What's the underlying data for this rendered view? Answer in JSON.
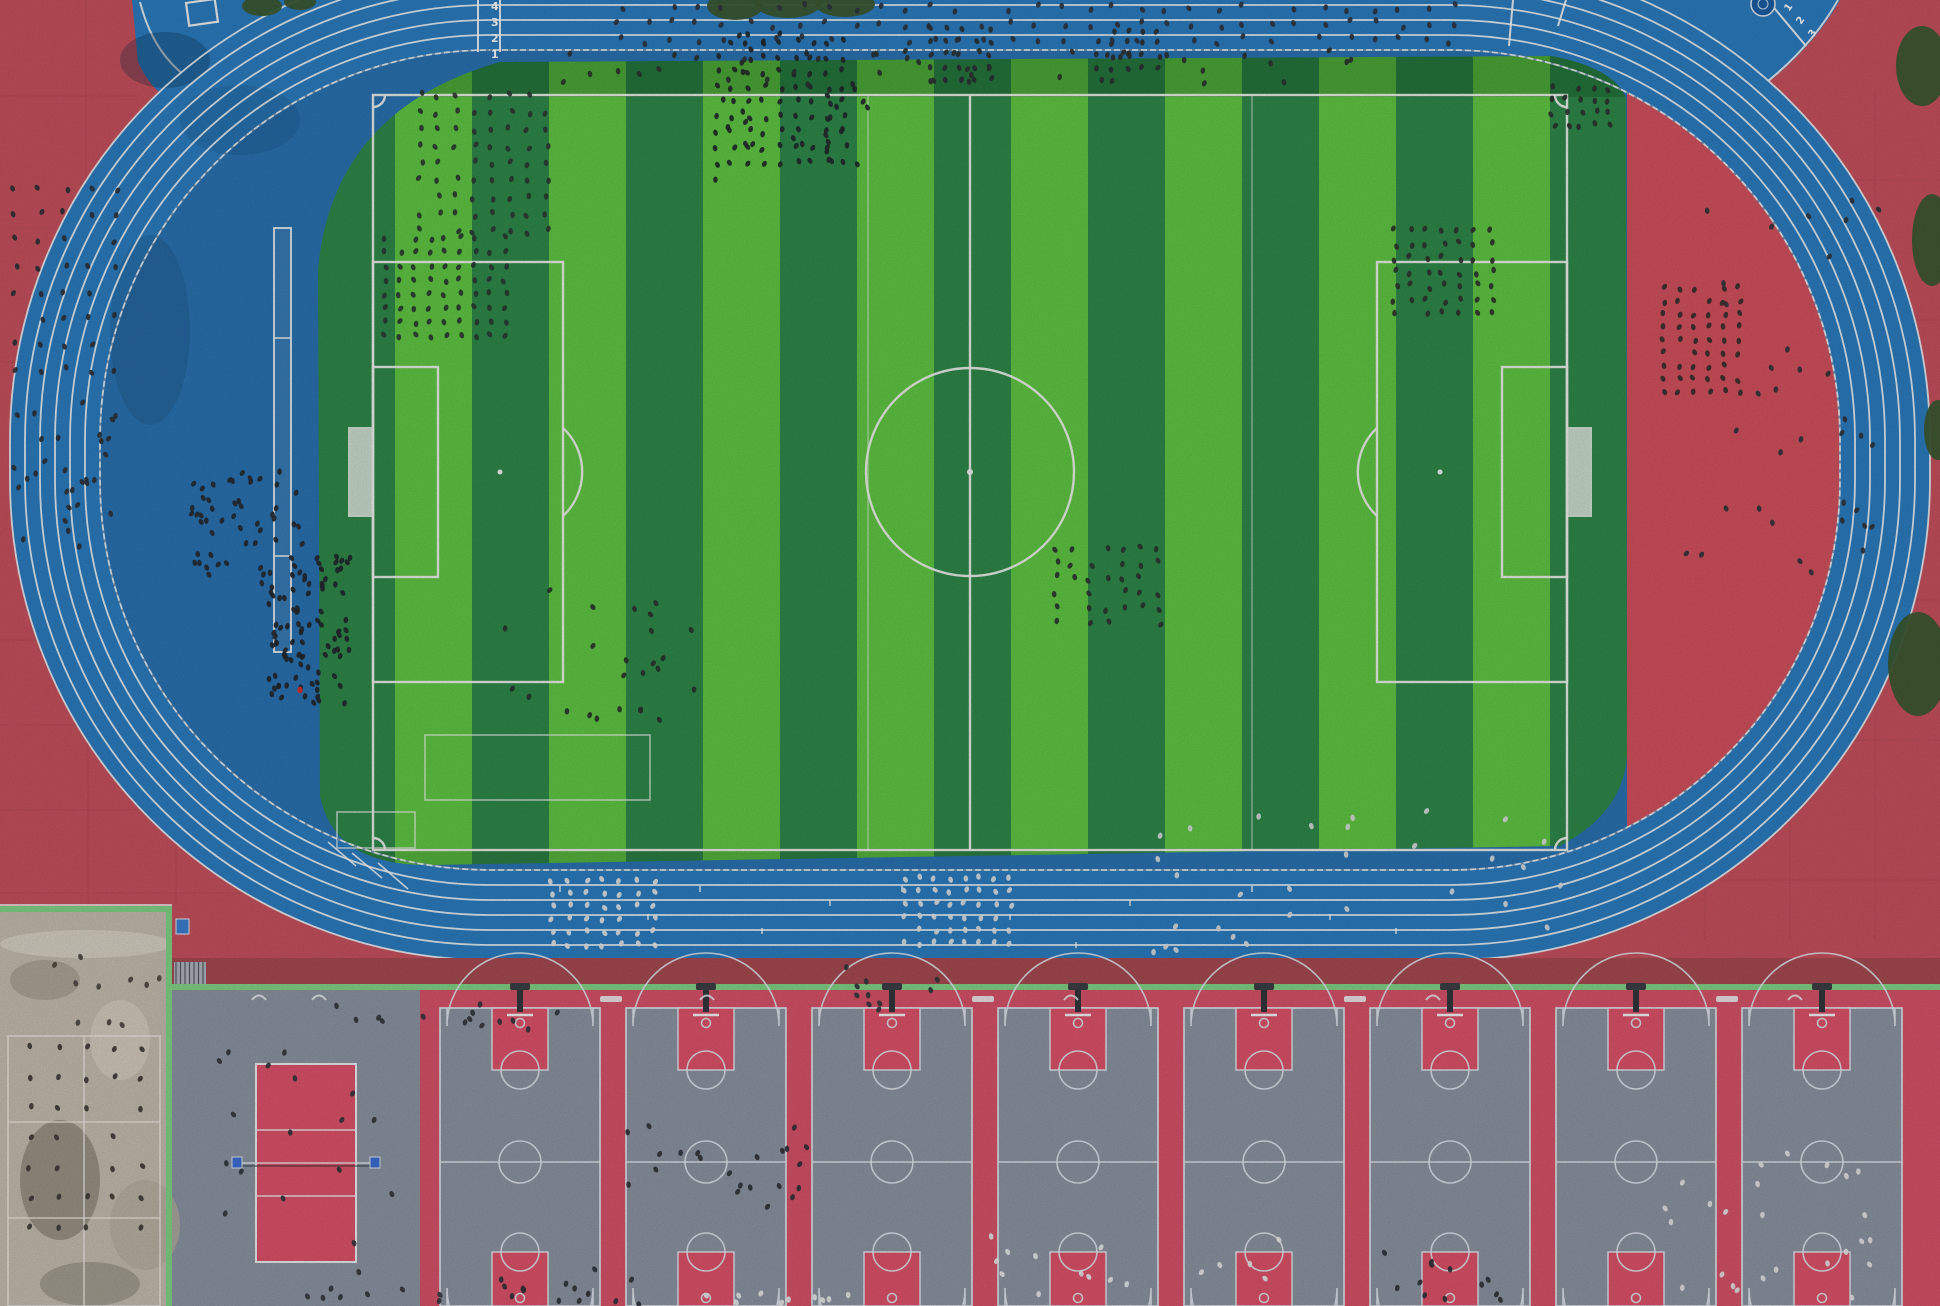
{
  "scene": {
    "title": "Aerial drone view of a school sports complex: blue 6-lane running track around a striped soccer field, red plazas, and a row of basketball courts with a volleyball court below",
    "width": 1940,
    "height": 1306
  },
  "colors": {
    "plaza_red": "#c9525f",
    "infield_red": "#d5525f",
    "strip_red": "#a84b52",
    "track_blue": "#2c7ec2",
    "track_blue_deep": "#2a74b4",
    "lane_line": "#f2f6f8",
    "grass_light": "#61c944",
    "grass_dark": "#2f8a4b",
    "field_line": "#f2f4ef",
    "court_gray": "#8d96a3",
    "court_red": "#d9536a",
    "court_pink": "#e0536b",
    "court_line": "#e6ebf2",
    "green_border": "#84d488",
    "concrete": "#c6bfb1",
    "tree_green": "#3c5a31",
    "people_dark": "#2b2f38",
    "people_light": "#e8eaea",
    "emblem_blue": "#1a5fa6",
    "net_post_blue": "#3d6fd6"
  },
  "track": {
    "outer": {
      "x": 10,
      "y": -40,
      "w": 1920,
      "h": 1000,
      "r": 480
    },
    "lane_width": 15,
    "lanes": 6,
    "inner": {
      "x": 100,
      "y": 50,
      "w": 1740,
      "h": 820,
      "r": 390
    },
    "start_lane_numbers_topleft": [
      {
        "label": "1",
        "x": 491,
        "y": 58
      },
      {
        "label": "2",
        "x": 491,
        "y": 42
      },
      {
        "label": "3",
        "x": 491,
        "y": 26
      },
      {
        "label": "4",
        "x": 491,
        "y": 10
      }
    ],
    "start_lane_numbers_topright": [
      {
        "label": "1",
        "x": 1789,
        "y": 12,
        "rot": -55
      },
      {
        "label": "2",
        "x": 1801,
        "y": 25,
        "rot": -55
      },
      {
        "label": "3",
        "x": 1813,
        "y": 38,
        "rot": -55
      }
    ],
    "start_lines": [
      {
        "x1": 500,
        "y1": 0,
        "x2": 500,
        "y2": 52
      },
      {
        "x1": 478,
        "y1": 0,
        "x2": 478,
        "y2": 52
      },
      {
        "x1": 1513,
        "y1": 0,
        "x2": 1509,
        "y2": 46
      },
      {
        "x1": 1566,
        "y1": 0,
        "x2": 1558,
        "y2": 26
      },
      {
        "x1": 1770,
        "y1": 3,
        "x2": 1806,
        "y2": 46
      }
    ],
    "stagger_marks": [
      [
        328,
        842,
        356,
        866
      ],
      [
        352,
        853,
        382,
        878
      ],
      [
        378,
        863,
        408,
        889
      ]
    ],
    "relay_ticks": [
      [
        560,
        886
      ],
      [
        648,
        914
      ],
      [
        700,
        886
      ],
      [
        762,
        928
      ],
      [
        830,
        900
      ],
      [
        902,
        886
      ],
      [
        1010,
        914
      ],
      [
        1076,
        942
      ],
      [
        1130,
        900
      ],
      [
        1252,
        886
      ],
      [
        1330,
        914
      ],
      [
        1396,
        928
      ]
    ],
    "emblem": {
      "cx": 1763,
      "cy": 4,
      "r": 12
    },
    "portable_goal": {
      "x": 186,
      "y": 3,
      "w": 29,
      "h": 23
    },
    "long_jump_runway": {
      "x": 274,
      "y": 228,
      "w": 17,
      "h": 424,
      "bars_y": [
        338,
        556
      ]
    }
  },
  "field": {
    "grass_left": 318,
    "grass_right": 1627,
    "grass_top": 55,
    "grass_bottom": 866,
    "stripe_width": 77,
    "stripe_count": 17,
    "bounds": {
      "x1": 373,
      "y1": 95,
      "x2": 1567,
      "y2": 850
    },
    "center": {
      "x": 970,
      "y": 472,
      "circle_r": 104
    },
    "penalty_box": {
      "depth": 190,
      "half_h": 210
    },
    "goal_box": {
      "depth": 65,
      "half_h": 105
    },
    "goal": {
      "depth": 24,
      "half_h": 44
    },
    "penalty_arc_r": 60,
    "training_lines_x": [
      868,
      1252
    ],
    "training_rects": [
      {
        "x": 337,
        "y": 812,
        "w": 78,
        "h": 36
      },
      {
        "x": 425,
        "y": 735,
        "w": 225,
        "h": 65
      }
    ],
    "infield_red_wedge": {
      "x": 1627,
      "y": 80,
      "w": 213,
      "h": 800
    }
  },
  "bottom": {
    "strip": {
      "x": 172,
      "y": 958,
      "w": 1768,
      "h": 28
    },
    "green_line": {
      "x": 172,
      "y": 984,
      "w": 1768,
      "h": 6
    },
    "courts_bg": {
      "x": 420,
      "y": 990,
      "w": 1520,
      "h": 316
    },
    "open_gray": {
      "x": 172,
      "y": 990,
      "w": 248,
      "h": 316
    },
    "basketball": {
      "count": 8,
      "first_left": 440,
      "width": 160,
      "gap": 26,
      "top": 1008,
      "half_y": 1162,
      "bottom_key_y": 1252,
      "key_w": 56,
      "key_h": 62,
      "ft_r": 19,
      "three_r": 73,
      "center_r": 21
    },
    "volleyball": {
      "x": 256,
      "y": 1064,
      "w": 100,
      "h": 198,
      "inner_lines_y": [
        1130,
        1196
      ],
      "net_y": 1163,
      "posts_x": [
        232,
        370
      ]
    },
    "lamp_hooks_x": [
      252,
      312,
      700,
      1064,
      1426,
      1788
    ],
    "court_labels_x": [
      600,
      972,
      1344,
      1716
    ]
  },
  "concrete_area": {
    "x": 0,
    "y": 908,
    "w": 172,
    "h": 398,
    "court_rect": {
      "x": 8,
      "y": 1036,
      "w": 152,
      "h": 270
    },
    "inner_lines_y": [
      1122,
      1218
    ],
    "mid_line_x": 84,
    "stairs": {
      "x": 174,
      "y": 962,
      "w": 32,
      "h": 22
    },
    "blue_sign": {
      "x": 176,
      "y": 919,
      "w": 13,
      "h": 15
    }
  },
  "trees": [
    {
      "cx": 735,
      "cy": 6,
      "rx": 28,
      "ry": 14
    },
    {
      "cx": 788,
      "cy": 2,
      "rx": 34,
      "ry": 16
    },
    {
      "cx": 845,
      "cy": 4,
      "rx": 30,
      "ry": 13
    },
    {
      "cx": 262,
      "cy": 6,
      "rx": 20,
      "ry": 10
    },
    {
      "cx": 300,
      "cy": 2,
      "rx": 16,
      "ry": 8
    },
    {
      "cx": 1922,
      "cy": 66,
      "rx": 26,
      "ry": 40
    },
    {
      "cx": 1932,
      "cy": 240,
      "rx": 20,
      "ry": 46
    },
    {
      "cx": 1918,
      "cy": 664,
      "rx": 30,
      "ry": 52
    },
    {
      "cx": 1938,
      "cy": 430,
      "rx": 14,
      "ry": 30
    }
  ],
  "people": {
    "formations": [
      {
        "name": "plaza-left-grid",
        "x": 15,
        "y": 188,
        "cols": 5,
        "rows": 8,
        "dx": 25,
        "dy": 26,
        "color": "#2e3138",
        "jitter": 3
      },
      {
        "name": "field-grid-1",
        "x": 385,
        "y": 238,
        "cols": 9,
        "rows": 8,
        "dx": 15,
        "dy": 14,
        "color": "#2b3a32",
        "jitter": 2
      },
      {
        "name": "field-grid-2",
        "x": 420,
        "y": 95,
        "cols": 8,
        "rows": 9,
        "dx": 18,
        "dy": 17,
        "color": "#2e3a33",
        "jitter": 3
      },
      {
        "name": "field-grid-3",
        "x": 716,
        "y": 42,
        "cols": 9,
        "rows": 9,
        "dx": 16,
        "dy": 15,
        "color": "#23292b",
        "jitter": 3
      },
      {
        "name": "field-grid-4",
        "x": 930,
        "y": 28,
        "cols": 5,
        "rows": 5,
        "dx": 15,
        "dy": 13,
        "color": "#2b3034",
        "jitter": 2
      },
      {
        "name": "field-grid-5",
        "x": 1098,
        "y": 30,
        "cols": 5,
        "rows": 4,
        "dx": 15,
        "dy": 13,
        "color": "#2b3034",
        "jitter": 2
      },
      {
        "name": "field-grid-right",
        "x": 1395,
        "y": 230,
        "cols": 7,
        "rows": 7,
        "dx": 16,
        "dy": 14,
        "color": "#30342e",
        "jitter": 3
      },
      {
        "name": "field-grid-corner",
        "x": 1553,
        "y": 88,
        "cols": 5,
        "rows": 4,
        "dx": 14,
        "dy": 12,
        "color": "#2e332f",
        "jitter": 3
      },
      {
        "name": "field-grid-low",
        "x": 1056,
        "y": 548,
        "cols": 7,
        "rows": 6,
        "dx": 17,
        "dy": 15,
        "color": "#2c3531",
        "jitter": 3
      },
      {
        "name": "red-right-grid",
        "x": 1664,
        "y": 288,
        "cols": 6,
        "rows": 9,
        "dx": 15,
        "dy": 13,
        "color": "#35302c",
        "jitter": 2
      },
      {
        "name": "track-top-rows",
        "x": 620,
        "y": 8,
        "cols": 33,
        "rows": 3,
        "dx": 26,
        "dy": 16,
        "color": "#2f3440",
        "jitter": 4
      },
      {
        "name": "track-bottom-white-1",
        "x": 552,
        "y": 880,
        "cols": 7,
        "rows": 6,
        "dx": 17,
        "dy": 13,
        "color": "#e9eaea",
        "jitter": 2
      },
      {
        "name": "track-bottom-white-2",
        "x": 905,
        "y": 878,
        "cols": 8,
        "rows": 6,
        "dx": 15,
        "dy": 13,
        "color": "#e3e6e8",
        "jitter": 2
      },
      {
        "name": "concrete-grid",
        "x": 30,
        "y": 1048,
        "cols": 5,
        "rows": 7,
        "dx": 28,
        "dy": 30,
        "color": "#3e3b36",
        "jitter": 2
      }
    ],
    "clusters": [
      {
        "name": "plaza-left-scatter",
        "x": 10,
        "y": 395,
        "w": 120,
        "h": 170,
        "n": 30,
        "color": "#2e3138"
      },
      {
        "name": "apron-left-cluster",
        "x": 190,
        "y": 468,
        "w": 120,
        "h": 125,
        "n": 55,
        "color": "#262a31"
      },
      {
        "name": "field-left-crowd",
        "x": 268,
        "y": 555,
        "w": 85,
        "h": 150,
        "n": 90,
        "color": "#23272e"
      },
      {
        "name": "field-blob-extra",
        "x": 700,
        "y": 30,
        "w": 170,
        "h": 150,
        "n": 30,
        "color": "#23292b"
      },
      {
        "name": "field-low-scatter",
        "x": 495,
        "y": 590,
        "w": 200,
        "h": 130,
        "n": 25,
        "color": "#2b332e"
      },
      {
        "name": "field-topline",
        "x": 560,
        "y": 50,
        "w": 800,
        "h": 35,
        "n": 45,
        "color": "#2d3330"
      },
      {
        "name": "curve-right-scatter",
        "x": 1680,
        "y": 180,
        "w": 200,
        "h": 420,
        "n": 35,
        "color": "#30343c"
      },
      {
        "name": "curve-bottom-scatter",
        "x": 1150,
        "y": 800,
        "w": 420,
        "h": 160,
        "n": 30,
        "color": "#dfe2e4"
      },
      {
        "name": "courts-row-top",
        "x": 320,
        "y": 995,
        "w": 240,
        "h": 40,
        "n": 14,
        "color": "#33363c"
      },
      {
        "name": "volleyball-around",
        "x": 200,
        "y": 1050,
        "w": 200,
        "h": 240,
        "n": 18,
        "color": "#33363c"
      },
      {
        "name": "court2-group",
        "x": 620,
        "y": 1125,
        "w": 190,
        "h": 90,
        "n": 22,
        "color": "#2f3237"
      },
      {
        "name": "court-mid-group",
        "x": 980,
        "y": 1235,
        "w": 300,
        "h": 60,
        "n": 16,
        "color": "#eceeee"
      },
      {
        "name": "court-low-left",
        "x": 500,
        "y": 1265,
        "w": 140,
        "h": 40,
        "n": 14,
        "color": "#2f3237"
      },
      {
        "name": "court-right-group",
        "x": 1660,
        "y": 1140,
        "w": 220,
        "h": 160,
        "n": 25,
        "color": "#e8e9ea"
      },
      {
        "name": "hoop1-group",
        "x": 840,
        "y": 965,
        "w": 100,
        "h": 45,
        "n": 10,
        "color": "#33363c"
      },
      {
        "name": "court-low-mid",
        "x": 1360,
        "y": 1240,
        "w": 170,
        "h": 60,
        "n": 12,
        "color": "#2f3237"
      },
      {
        "name": "court-bottom-row1",
        "x": 290,
        "y": 1288,
        "w": 160,
        "h": 16,
        "n": 8,
        "color": "#33363c"
      },
      {
        "name": "court-bottom-row2",
        "x": 690,
        "y": 1288,
        "w": 170,
        "h": 16,
        "n": 10,
        "color": "#eceeee"
      },
      {
        "name": "concrete-scatter",
        "x": 5,
        "y": 950,
        "w": 160,
        "h": 80,
        "n": 10,
        "color": "#4a463f"
      }
    ],
    "red_shirt_person": {
      "x": 300,
      "y": 690
    }
  }
}
